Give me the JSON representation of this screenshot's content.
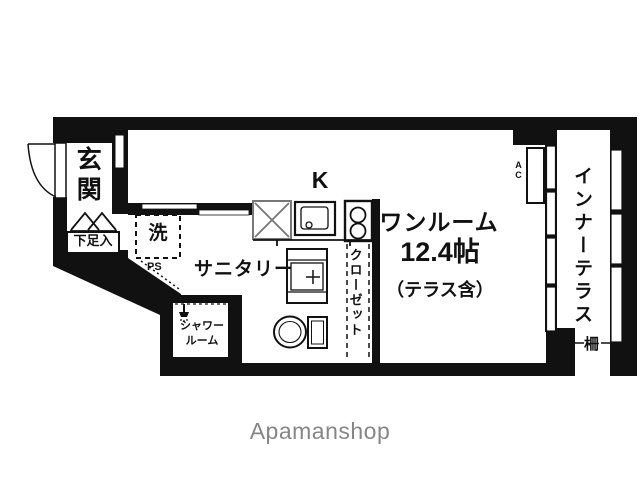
{
  "colors": {
    "wall": "#111111",
    "fixture_gray": "#777777",
    "watermark_gray": "#868686"
  },
  "floor_plan": {
    "entrance": {
      "label": "玄関",
      "shoe_box": "下足入"
    },
    "sanitary": {
      "label": "サニタリー",
      "washer": "洗",
      "pipe_space": "PS",
      "shower_line1": "シャワー",
      "shower_line2": "ルーム"
    },
    "kitchen": {
      "label": "K"
    },
    "closet": {
      "label": "クローゼット"
    },
    "main_room": {
      "name": "ワンルーム",
      "size": "12.4帖",
      "note": "（テラス含）",
      "ac": "AC"
    },
    "terrace": {
      "label": "インナーテラス",
      "fence": "柵"
    }
  },
  "watermark": "Apamanshop"
}
